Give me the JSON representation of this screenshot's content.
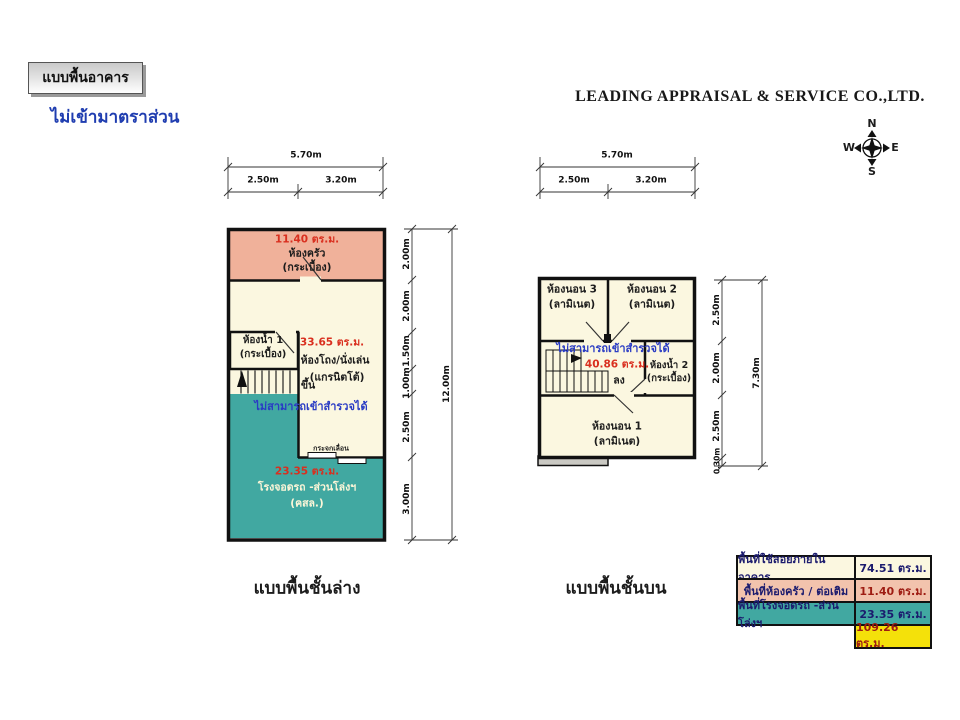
{
  "header": {
    "box_label": "แบบพื้นอาคาร",
    "scale_note": "ไม่เข้ามาตราส่วน",
    "company": "LEADING APPRAISAL & SERVICE CO.,LTD."
  },
  "compass": {
    "n": "N",
    "e": "E",
    "s": "S",
    "w": "W"
  },
  "ground_floor": {
    "caption": "แบบพื้นชั้นล่าง",
    "dims_top": {
      "total": "5.70m",
      "seg1": "2.50m",
      "seg2": "3.20m"
    },
    "dims_side": {
      "segs": [
        "2.00m",
        "2.00m",
        "1.50m",
        "1.00m",
        "2.50m",
        "3.00m"
      ],
      "total": "12.00m"
    },
    "kitchen": {
      "area": "11.40 ตร.ม.",
      "name": "ห้องครัว",
      "finish": "(กระเบื้อง)"
    },
    "bath": {
      "name": "ห้องน้ำ 1",
      "finish": "(กระเบื้อง)"
    },
    "hall": {
      "area": "33.65 ตร.ม.",
      "name": "ห้องโถง/นั่งเล่น",
      "finish": "(แกรนิตโต้)"
    },
    "stair_label": "ขึ้น",
    "no_survey": "ไม่สามารถเข้าสำรวจได้",
    "sliding_door": "กระจกเลื่อน",
    "carport": {
      "area": "23.35 ตร.ม.",
      "name": "โรงจอดรถ -ส่วนโล่งฯ",
      "finish": "(คสล.)"
    }
  },
  "upper_floor": {
    "caption": "แบบพื้นชั้นบน",
    "dims_top": {
      "total": "5.70m",
      "seg1": "2.50m",
      "seg2": "3.20m"
    },
    "dims_side": {
      "segs": [
        "2.50m",
        "2.00m",
        "2.50m",
        "0.30m"
      ],
      "total": "7.30m"
    },
    "bed3": {
      "name": "ห้องนอน 3",
      "finish": "(ลามิเนต)"
    },
    "bed2": {
      "name": "ห้องนอน 2",
      "finish": "(ลามิเนต)"
    },
    "bed1": {
      "name": "ห้องนอน 1",
      "finish": "(ลามิเนต)"
    },
    "bath": {
      "name": "ห้องน้ำ 2",
      "finish": "(กระเบื้อง)"
    },
    "no_survey": "ไม่สามารถเข้าสำรวจได้",
    "area": "40.86 ตร.ม.",
    "stair_label": "ลง"
  },
  "area_table": {
    "rows": [
      {
        "label": "พื้นที่ใช้สอยภายในอาคาร",
        "value": "74.51 ตร.ม."
      },
      {
        "label": "พื้นที่ห้องครัว / ต่อเติม",
        "value": "11.40 ตร.ม."
      },
      {
        "label": "พื้นที่โรงจอดรถ -ส่วนโล่งฯ",
        "value": "23.35 ตร.ม."
      },
      {
        "label": "",
        "value": "109.26 ตร.ม."
      }
    ]
  },
  "colors": {
    "kitchen_pink": "#f0b19a",
    "cream": "#fbf7e0",
    "teal": "#41a8a1",
    "total_yellow": "#f4e10a",
    "area_red": "#d92f1f",
    "note_blue": "#2a3cc4",
    "table_navy": "#1b1b6e",
    "table_dark_red": "#9e1c12",
    "wall_black": "#111111",
    "ledge_gray": "#cac9c3"
  }
}
